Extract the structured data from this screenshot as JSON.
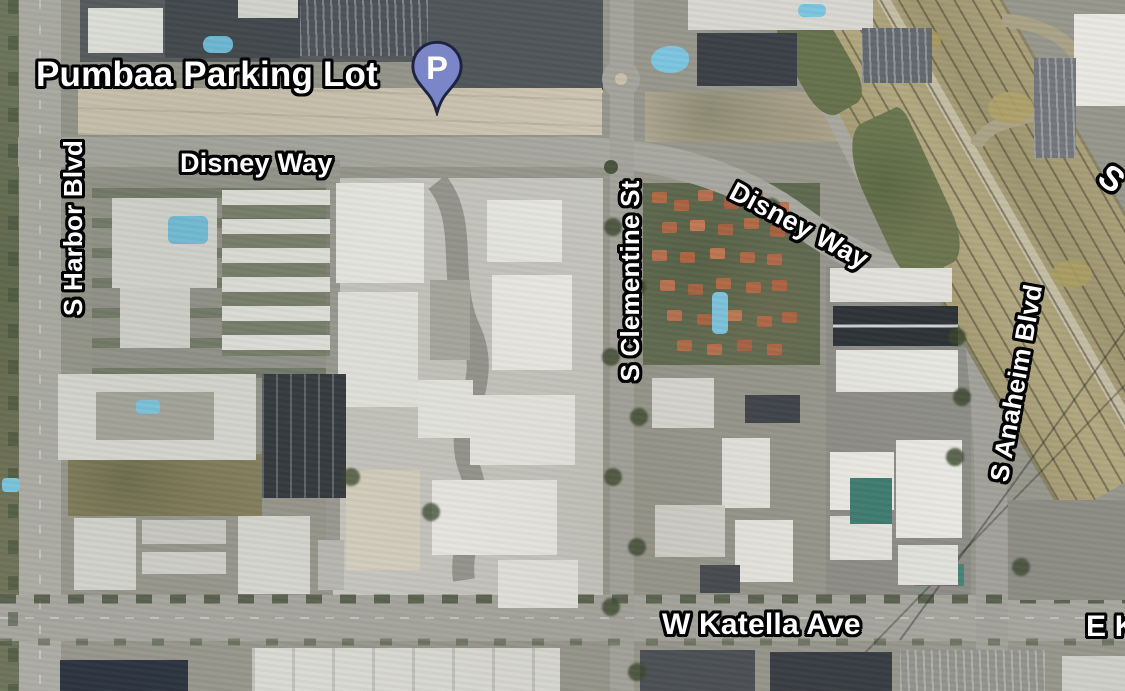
{
  "view": {
    "type": "satellite-map"
  },
  "poi": {
    "label": "Pumbaa Parking Lot",
    "marker_letter": "P"
  },
  "roads": {
    "harbor": "S Harbor Blvd",
    "disney_west": "Disney Way",
    "disney_east": "Disney Way",
    "clementine": "S Clementine St",
    "anaheim": "S Anaheim Blvd",
    "katella_west": "W Katella Ave",
    "katella_east": "E Ka",
    "edge_top_right": "S"
  },
  "colors": {
    "marker_fill": "#7b86c8",
    "marker_outline": "#1d2340",
    "label_text": "#ffffff",
    "label_outline": "#000000",
    "road_gray": "#a8a8a1",
    "freeway_tan": "#ada37a",
    "pool_blue": "#7cc6e0",
    "condo_roof": "#b46a45"
  }
}
